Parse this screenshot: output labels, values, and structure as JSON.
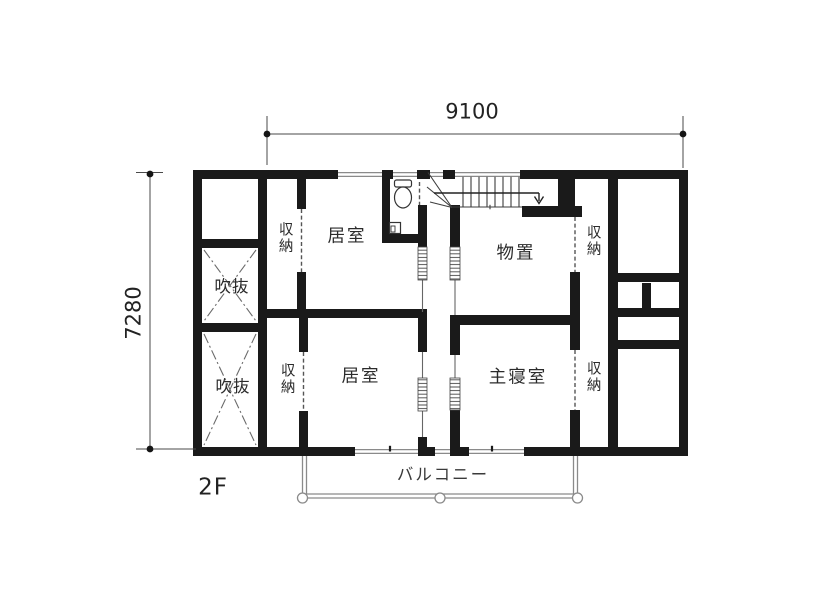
{
  "floor_plan": {
    "floor_label": "2F",
    "dimensions": {
      "width_mm": "9100",
      "depth_mm": "7280"
    },
    "rooms": {
      "void_upper": "吹抜",
      "void_lower": "吹抜",
      "closet_upper_left": "収納",
      "closet_lower_left": "収納",
      "closet_upper_right": "収納",
      "closet_lower_right": "収納",
      "room_upper": "居室",
      "room_lower": "居室",
      "storage": "物置",
      "master_bedroom": "主寝室",
      "balcony": "バルコニー"
    },
    "colors": {
      "wall": "#1a1a1a",
      "thin_line": "#8a8a8a",
      "text": "#2b2b2b",
      "background": "#ffffff"
    }
  }
}
